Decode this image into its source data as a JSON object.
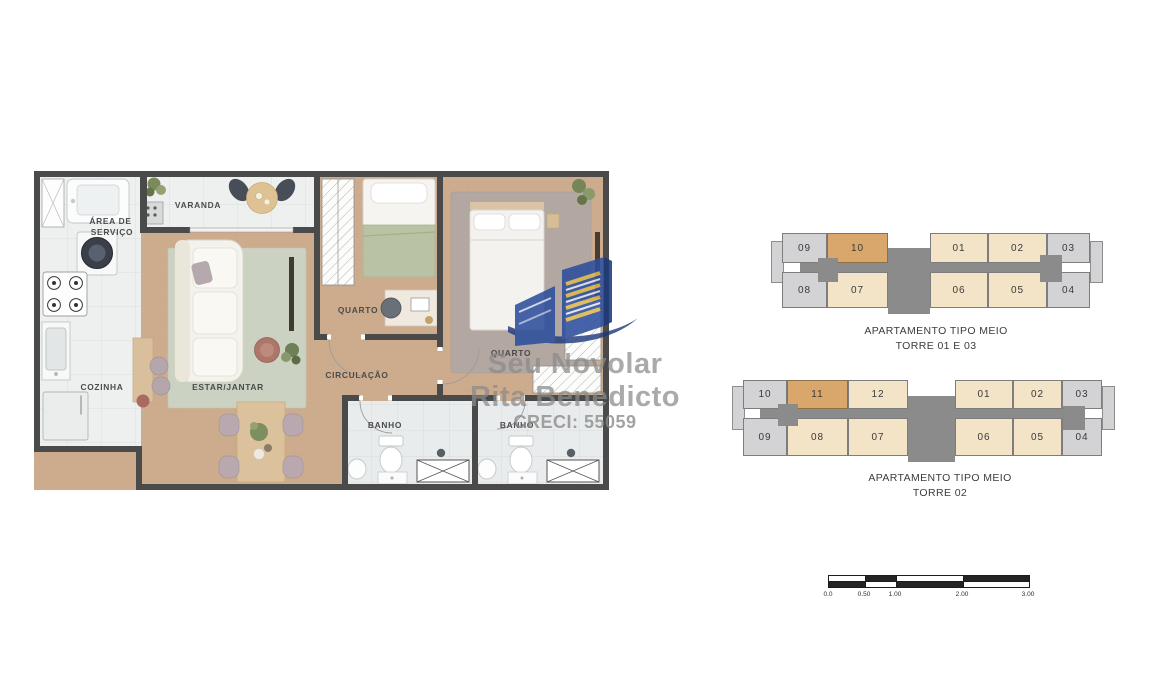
{
  "floorplan": {
    "rooms": {
      "area_servico_line1": "ÁREA DE",
      "area_servico_line2": "SERVIÇO",
      "varanda": "VARANDA",
      "quarto_small": "QUARTO",
      "quarto_large": "QUARTO",
      "estar_jantar": "ESTAR/JANTAR",
      "circulacao": "CIRCULAÇÃO",
      "cozinha": "COZINHA",
      "banho_1": "BANHO",
      "banho_2": "BANHO"
    }
  },
  "watermark": {
    "brand": "Seu Novolar",
    "agent": "Rita Benedicto",
    "creci": "CRECI: 55059"
  },
  "keyplans": [
    {
      "title1": "APARTAMENTO TIPO MEIO",
      "title2": "TORRE 01 E 03",
      "top": [
        {
          "label": "09",
          "style": "gray"
        },
        {
          "label": "10",
          "style": "highlight"
        },
        {
          "label": "01",
          "style": "cream"
        },
        {
          "label": "02",
          "style": "cream"
        },
        {
          "label": "03",
          "style": "gray"
        }
      ],
      "bottom": [
        {
          "label": "08",
          "style": "gray"
        },
        {
          "label": "07",
          "style": "cream"
        },
        {
          "label": "06",
          "style": "cream"
        },
        {
          "label": "05",
          "style": "cream"
        },
        {
          "label": "04",
          "style": "gray"
        }
      ]
    },
    {
      "title1": "APARTAMENTO TIPO MEIO",
      "title2": "TORRE 02",
      "top": [
        {
          "label": "10",
          "style": "gray"
        },
        {
          "label": "11",
          "style": "highlight"
        },
        {
          "label": "12",
          "style": "cream"
        },
        {
          "label": "01",
          "style": "cream"
        },
        {
          "label": "02",
          "style": "cream"
        },
        {
          "label": "03",
          "style": "gray"
        }
      ],
      "bottom": [
        {
          "label": "09",
          "style": "gray"
        },
        {
          "label": "08",
          "style": "cream"
        },
        {
          "label": "07",
          "style": "cream"
        },
        {
          "label": "06",
          "style": "cream"
        },
        {
          "label": "05",
          "style": "cream"
        },
        {
          "label": "04",
          "style": "gray"
        }
      ]
    }
  ],
  "scalebar": {
    "labels": [
      "0.0",
      "0.50",
      "1.00",
      "2.00",
      "3.00"
    ]
  },
  "colors": {
    "wall": "#4a4a4a",
    "wood": "#cdac8e",
    "tile": "#eef0f0",
    "tile_line": "#dcdfdf",
    "bath_tile": "#e9eced",
    "rug_living": "#cbd2c2",
    "rug_bedroom": "#b2a8a1",
    "unit_cream": "#f3e4c8",
    "unit_gray": "#d3d3d5",
    "unit_highlight": "#d9a76c",
    "core_gray": "#8b8b8b",
    "label_text": "#4b4b4b",
    "logo_blue": "#2e4f9e",
    "logo_dark_blue": "#1d3a7c",
    "logo_yellow": "#ddb84e",
    "watermark_text": "#8a8a8a"
  }
}
